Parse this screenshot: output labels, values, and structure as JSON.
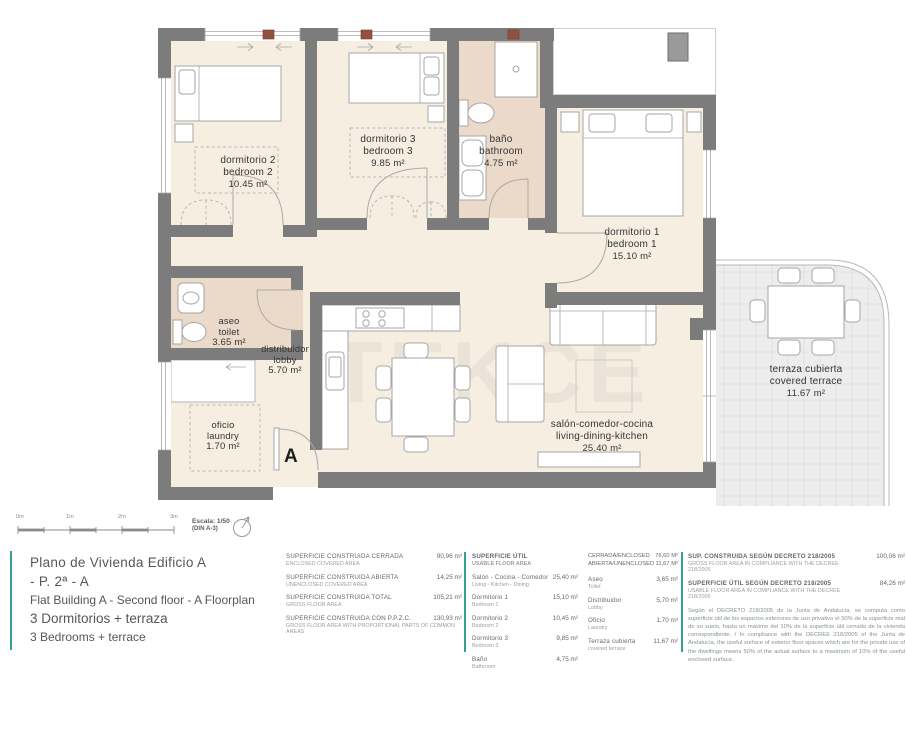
{
  "colors": {
    "accent": "#31a295",
    "wall": "#7c7c7c",
    "room": "#f6eee1",
    "wet": "#ebd9c9",
    "terrace": "#ededed"
  },
  "plan": {
    "watermark": "TEKCE",
    "section_label": "A",
    "rooms": {
      "bedroom2": {
        "es": "dormitorio 2",
        "en": "bedroom 2",
        "area": "10.45 m²"
      },
      "bedroom3": {
        "es": "dormitorio 3",
        "en": "bedroom 3",
        "area": "9.85 m²"
      },
      "bathroom": {
        "es": "baño",
        "en": "bathroom",
        "area": "4.75 m²"
      },
      "bedroom1": {
        "es": "dormitorio 1",
        "en": "bedroom 1",
        "area": "15.10 m²"
      },
      "toilet": {
        "es": "aseo",
        "en": "toilet",
        "area": "3.65 m²"
      },
      "lobby": {
        "es": "distribuidor",
        "en": "lobby",
        "area": "5.70 m²"
      },
      "laundry": {
        "es": "oficio",
        "en": "laundry",
        "area": "1.70 m²"
      },
      "living": {
        "es": "salón-comedor-cocina",
        "en": "living-dining-kitchen",
        "area": "25.40 m²"
      },
      "terrace": {
        "es": "terraza cubierta",
        "en": "covered terrace",
        "area": "11.67 m²"
      }
    }
  },
  "scale": {
    "ticks": [
      "0m",
      "1m",
      "2m",
      "3m"
    ],
    "label": "Escala: 1/50",
    "sheet": "(DIN A-3)"
  },
  "title_block": {
    "title_es": "Plano de Vivienda Edificio A - P. 2ª - A",
    "title_en": "Flat Building A - Second floor - A  Floorplan",
    "subtitle_es": "3 Dormitorios + terraza",
    "subtitle_en": "3 Bedrooms + terrace"
  },
  "tables": {
    "construida": {
      "rows": [
        {
          "es": "SUPERFICIE CONSTRUIDA CERRADA",
          "en": "ENCLOSED COVERED AREA",
          "value": "90,96 m²"
        },
        {
          "es": "SUPERFICIE CONSTRUIDA ABIERTA",
          "en": "UNENCLOSED COVERED AREA",
          "value": "14,25 m²"
        },
        {
          "es": "SUPERFICIE CONSTRUIDA TOTAL",
          "en": "GROSS FLOOR AREA",
          "value": "105,21 m²"
        },
        {
          "es": "SUPERFICIE CONSTRUIDA CON P.P.Z.C.",
          "en": "GROSS FLOOR AREA WITH PROPORTIONAL PARTS OF COMMON AREAS",
          "value": "130,93 m²"
        }
      ]
    },
    "util": {
      "header_es": "SUPERFICIE ÚTIL",
      "header_en": "USABLE FLOOR AREA",
      "rows": [
        {
          "es": "Salón - Cocina - Comedor",
          "en": "Living - Kitchen - Dining",
          "value": "25,40 m²"
        },
        {
          "es": "Dormitorio 1",
          "en": "Bedroom 1",
          "value": "15,10 m²"
        },
        {
          "es": "Dormitorio 2",
          "en": "Bedroom 2",
          "value": "10,45 m²"
        },
        {
          "es": "Dormitorio 3",
          "en": "Bedroom 3",
          "value": "9,85 m²"
        },
        {
          "es": "Baño",
          "en": "Bathroom",
          "value": "4,75 m²"
        }
      ],
      "summary": [
        {
          "label": "CERRADA/ENCLOSED",
          "value": "76,60 m²"
        },
        {
          "label": "ABIERTA/UNENCLOSED",
          "value": "11,67 m²"
        }
      ],
      "rows2": [
        {
          "es": "Aseo",
          "en": "Toilet",
          "value": "3,65 m²"
        },
        {
          "es": "Distribuidor",
          "en": "Lobby",
          "value": "5,70 m²"
        },
        {
          "es": "Oficio",
          "en": "Laundry",
          "value": "1,70 m²"
        },
        {
          "es": "Terraza cubierta",
          "en": "covered terrace",
          "value": "11,67 m²"
        }
      ]
    },
    "decreto": {
      "rows": [
        {
          "es": "SUP. CONSTRUIDA SEGÚN DECRETO 218/2005",
          "en": "GROSS FLOOR AREA IN COMPLIANCE WITH THE DECREE 218/2005",
          "value": "100,06 m²"
        },
        {
          "es": "SUPERFICIE ÚTIL SEGÚN DECRETO 218/2005",
          "en": "USABLE FLOOR AREA IN COMPLIANCE WITH THE DECREE 218/2005",
          "value": "84,26 m²"
        }
      ],
      "note": "Según el DECRETO 218/2005 de la Junta de Andalucía, se computa como superficie útil de los espacios exteriores de uso privativo el 50% de la superficie real de su suelo, hasta un máximo del 10% de la superficie útil cerrada de la vivienda correspondiente. / In compliance with the DECREE 218/2005 of the Junta de Andalucía, the useful surface of exterior floor spaces which are for the private use of the dwellings means 50% of the actual surface to a maximum of 10% of the useful enclosed surface."
    }
  }
}
